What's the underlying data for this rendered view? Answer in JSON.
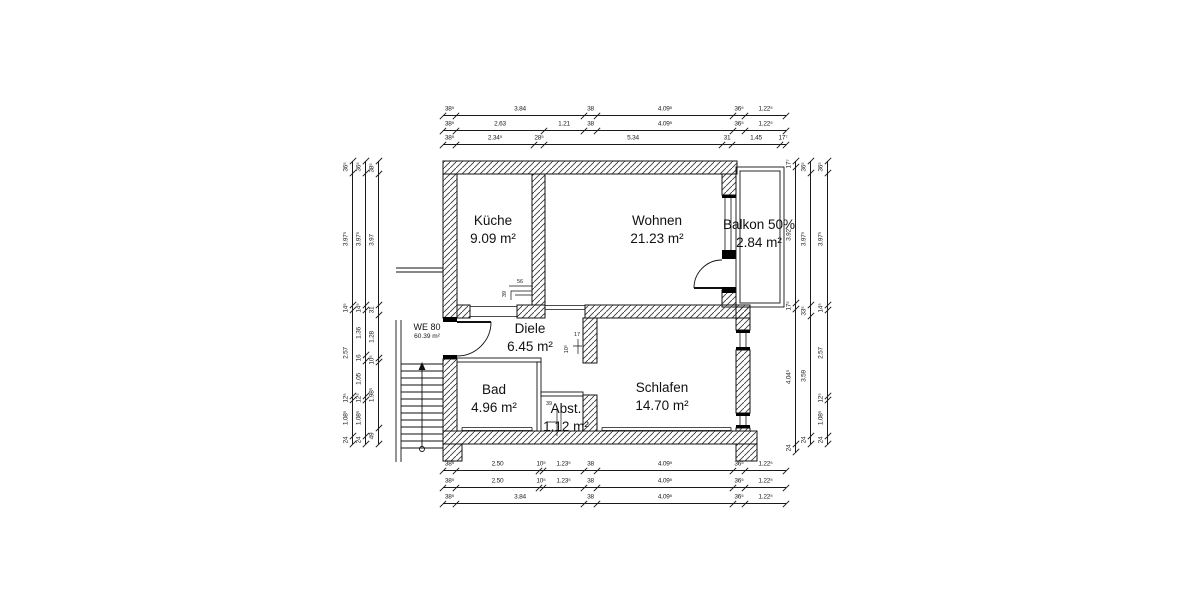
{
  "drawing": {
    "unit_label": {
      "line1": "WE 80",
      "line2": "60.39 m²"
    },
    "rooms": [
      {
        "id": "kueche",
        "label": "Küche",
        "area": "9.09 m²",
        "cx": 493,
        "cy": 212
      },
      {
        "id": "wohnen",
        "label": "Wohnen",
        "area": "21.23 m²",
        "cx": 657,
        "cy": 212
      },
      {
        "id": "balkon",
        "label": "Balkon 50%",
        "area": "2.84 m²",
        "cx": 759,
        "cy": 216
      },
      {
        "id": "diele",
        "label": "Diele",
        "area": "6.45 m²",
        "cx": 530,
        "cy": 320
      },
      {
        "id": "bad",
        "label": "Bad",
        "area": "4.96 m²",
        "cx": 494,
        "cy": 381
      },
      {
        "id": "abst",
        "label": "Abst.",
        "area": "1.12 m²",
        "cx": 566,
        "cy": 400
      },
      {
        "id": "schlafen",
        "label": "Schlafen",
        "area": "14.70 m²",
        "cx": 662,
        "cy": 379
      }
    ],
    "dim_chains": [
      {
        "id": "top-1",
        "dir": "h",
        "pos": 115,
        "bounds": [
          443,
          456,
          584,
          597,
          733,
          745,
          786
        ],
        "labels": [
          "38⁵",
          "3.84",
          "38",
          "4.09⁵",
          "36⁵",
          "1.22⁵"
        ]
      },
      {
        "id": "top-2",
        "dir": "h",
        "pos": 130,
        "bounds": [
          443,
          456,
          544,
          584,
          597,
          733,
          745,
          786
        ],
        "labels": [
          "38⁵",
          "2.63",
          "1.21",
          "38",
          "4.09⁵",
          "36⁵",
          "1.22⁵"
        ]
      },
      {
        "id": "top-3",
        "dir": "h",
        "pos": 144,
        "bounds": [
          443,
          456,
          534,
          544,
          722,
          732,
          780,
          786
        ],
        "labels": [
          "38⁵",
          "2.34⁵",
          "28⁵",
          "5.34",
          "31",
          "1.45",
          "17⁷"
        ]
      },
      {
        "id": "bottom-1",
        "dir": "h",
        "pos": 470,
        "bounds": [
          443,
          456,
          539,
          543,
          584,
          597,
          733,
          745,
          786
        ],
        "labels": [
          "38⁵",
          "2.50",
          "10⁵",
          "1.23⁵",
          "38",
          "4.09⁵",
          "36⁵",
          "1.22⁵"
        ]
      },
      {
        "id": "bottom-2",
        "dir": "h",
        "pos": 487,
        "bounds": [
          443,
          456,
          539,
          543,
          584,
          597,
          733,
          745,
          786
        ],
        "labels": [
          "38⁵",
          "2.50",
          "10⁵",
          "1.23⁵",
          "38",
          "4.09⁵",
          "36⁵",
          "1.22⁵"
        ]
      },
      {
        "id": "bottom-3",
        "dir": "h",
        "pos": 503,
        "bounds": [
          443,
          456,
          584,
          597,
          733,
          745,
          786
        ],
        "labels": [
          "38⁵",
          "3.84",
          "38",
          "4.09⁵",
          "36⁵",
          "1.22⁵"
        ]
      },
      {
        "id": "left-outer",
        "dir": "v",
        "pos": 352,
        "bounds": [
          161,
          173,
          305,
          310,
          396,
          400,
          436,
          444
        ],
        "labels": [
          "36⁵",
          "3.97⁵",
          "14⁵",
          "2.57",
          "12⁵",
          "1.08⁵",
          "24"
        ]
      },
      {
        "id": "left-mid",
        "dir": "v",
        "pos": 365,
        "bounds": [
          161,
          173,
          305,
          310,
          355,
          361,
          396,
          400,
          436,
          444
        ],
        "labels": [
          "36⁵",
          "3.97⁵",
          "14⁵",
          "1.36",
          "16",
          "1.05",
          "12⁵",
          "1.08⁵",
          "24"
        ]
      },
      {
        "id": "left-inner",
        "dir": "v",
        "pos": 378,
        "bounds": [
          161,
          174,
          305,
          315,
          358,
          362,
          428,
          444
        ],
        "labels": [
          "38⁵",
          "3.97",
          "31",
          "1.28",
          "10⁵",
          "1.98⁵",
          "49"
        ]
      },
      {
        "id": "right-inner",
        "dir": "v",
        "pos": 795,
        "bounds": [
          161,
          167,
          303,
          309,
          444,
          452
        ],
        "labels": [
          "17⁷",
          "3.92",
          "17⁵",
          "4.04⁵",
          "24"
        ]
      },
      {
        "id": "right-mid",
        "dir": "v",
        "pos": 810,
        "bounds": [
          161,
          173,
          305,
          316,
          436,
          444
        ],
        "labels": [
          "36⁵",
          "3.97⁵",
          "33⁵",
          "3.59",
          "24"
        ]
      },
      {
        "id": "right-outer",
        "dir": "v",
        "pos": 827,
        "bounds": [
          161,
          173,
          305,
          310,
          396,
          400,
          436,
          444
        ],
        "labels": [
          "36⁵",
          "3.97⁵",
          "14⁵",
          "2.57",
          "12⁵",
          "1.08⁵",
          "24"
        ]
      }
    ],
    "annotations": [
      {
        "label": "56",
        "x": 520,
        "y": 282,
        "rot": "h"
      },
      {
        "label": "39",
        "x": 505,
        "y": 294,
        "rot": "v"
      },
      {
        "label": "17",
        "x": 577,
        "y": 335,
        "rot": "h"
      },
      {
        "label": "10⁵",
        "x": 567,
        "y": 349,
        "rot": "v"
      },
      {
        "label": "39",
        "x": 549,
        "y": 404,
        "rot": "h"
      }
    ],
    "colors": {
      "wall_stroke": "#111111",
      "hatch": "#3a3a3a",
      "text": "#111111",
      "dim": "#1a1a1a"
    }
  }
}
